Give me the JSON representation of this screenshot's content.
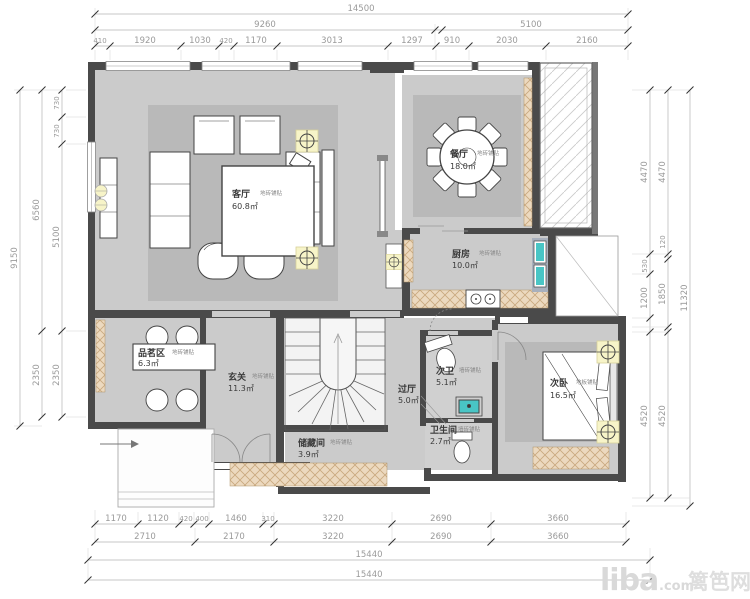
{
  "title": "residential-floor-plan",
  "rooms": {
    "living": {
      "name": "客厅",
      "area": "60.8㎡",
      "finish": "地砖铺贴"
    },
    "dining": {
      "name": "餐厅",
      "area": "18.0㎡",
      "finish": "地砖铺贴"
    },
    "kitchen": {
      "name": "厨房",
      "area": "10.0㎡",
      "finish": "地砖铺贴"
    },
    "tea": {
      "name": "品茗区",
      "area": "6.3㎡",
      "finish": "地砖铺贴"
    },
    "foyer": {
      "name": "玄关",
      "area": "11.3㎡",
      "finish": "地砖铺贴"
    },
    "hall": {
      "name": "过厅",
      "area": "5.0㎡"
    },
    "bath2": {
      "name": "次卫",
      "area": "5.1㎡",
      "finish": "墙砖铺贴"
    },
    "bathroom": {
      "name": "卫生间",
      "area": "2.7㎡",
      "finish": "墙砖铺贴"
    },
    "bedroom2": {
      "name": "次卧",
      "area": "16.5㎡",
      "finish": "地板铺贴"
    },
    "storage": {
      "name": "储藏间",
      "area": "3.9㎡",
      "finish": "地砖铺贴"
    }
  },
  "dimensions": {
    "top": {
      "overall": "14500",
      "row2": [
        "9260",
        "5100"
      ],
      "row3": [
        "410",
        "1920",
        "1030",
        "420",
        "1170",
        "3013",
        "1297",
        "910",
        "2030",
        "2160"
      ]
    },
    "bottom": {
      "row1": [
        "1170",
        "1120",
        "420",
        "400",
        "1460",
        "310",
        "3220",
        "2690",
        "3660"
      ],
      "row2": [
        "2710",
        "2170",
        "3220",
        "2690",
        "3660"
      ],
      "row3": "15440",
      "row4": "15440"
    },
    "left": {
      "outer": "9150",
      "mid": [
        "6560",
        "2350"
      ],
      "inner": [
        "730",
        "730",
        "5100",
        "2350"
      ]
    },
    "right": {
      "outer": "11320",
      "mid": [
        "4470",
        "120",
        "1850",
        "4520"
      ],
      "inner": [
        "4470",
        "530",
        "1200",
        "4520"
      ]
    }
  },
  "watermark": {
    "logo": "liba",
    "tld": ".com",
    "site": "篱笆网"
  },
  "colors": {
    "wall": "#4a4a4a",
    "floor": "#cbcbcb",
    "rug": "#b9b9b9",
    "cabinet_hatch": "#ecd9bf",
    "fixture_teal": "#49c5c5",
    "lamp_yellow": "#f7f4c8",
    "dimension_text": "#9a9a9a"
  }
}
